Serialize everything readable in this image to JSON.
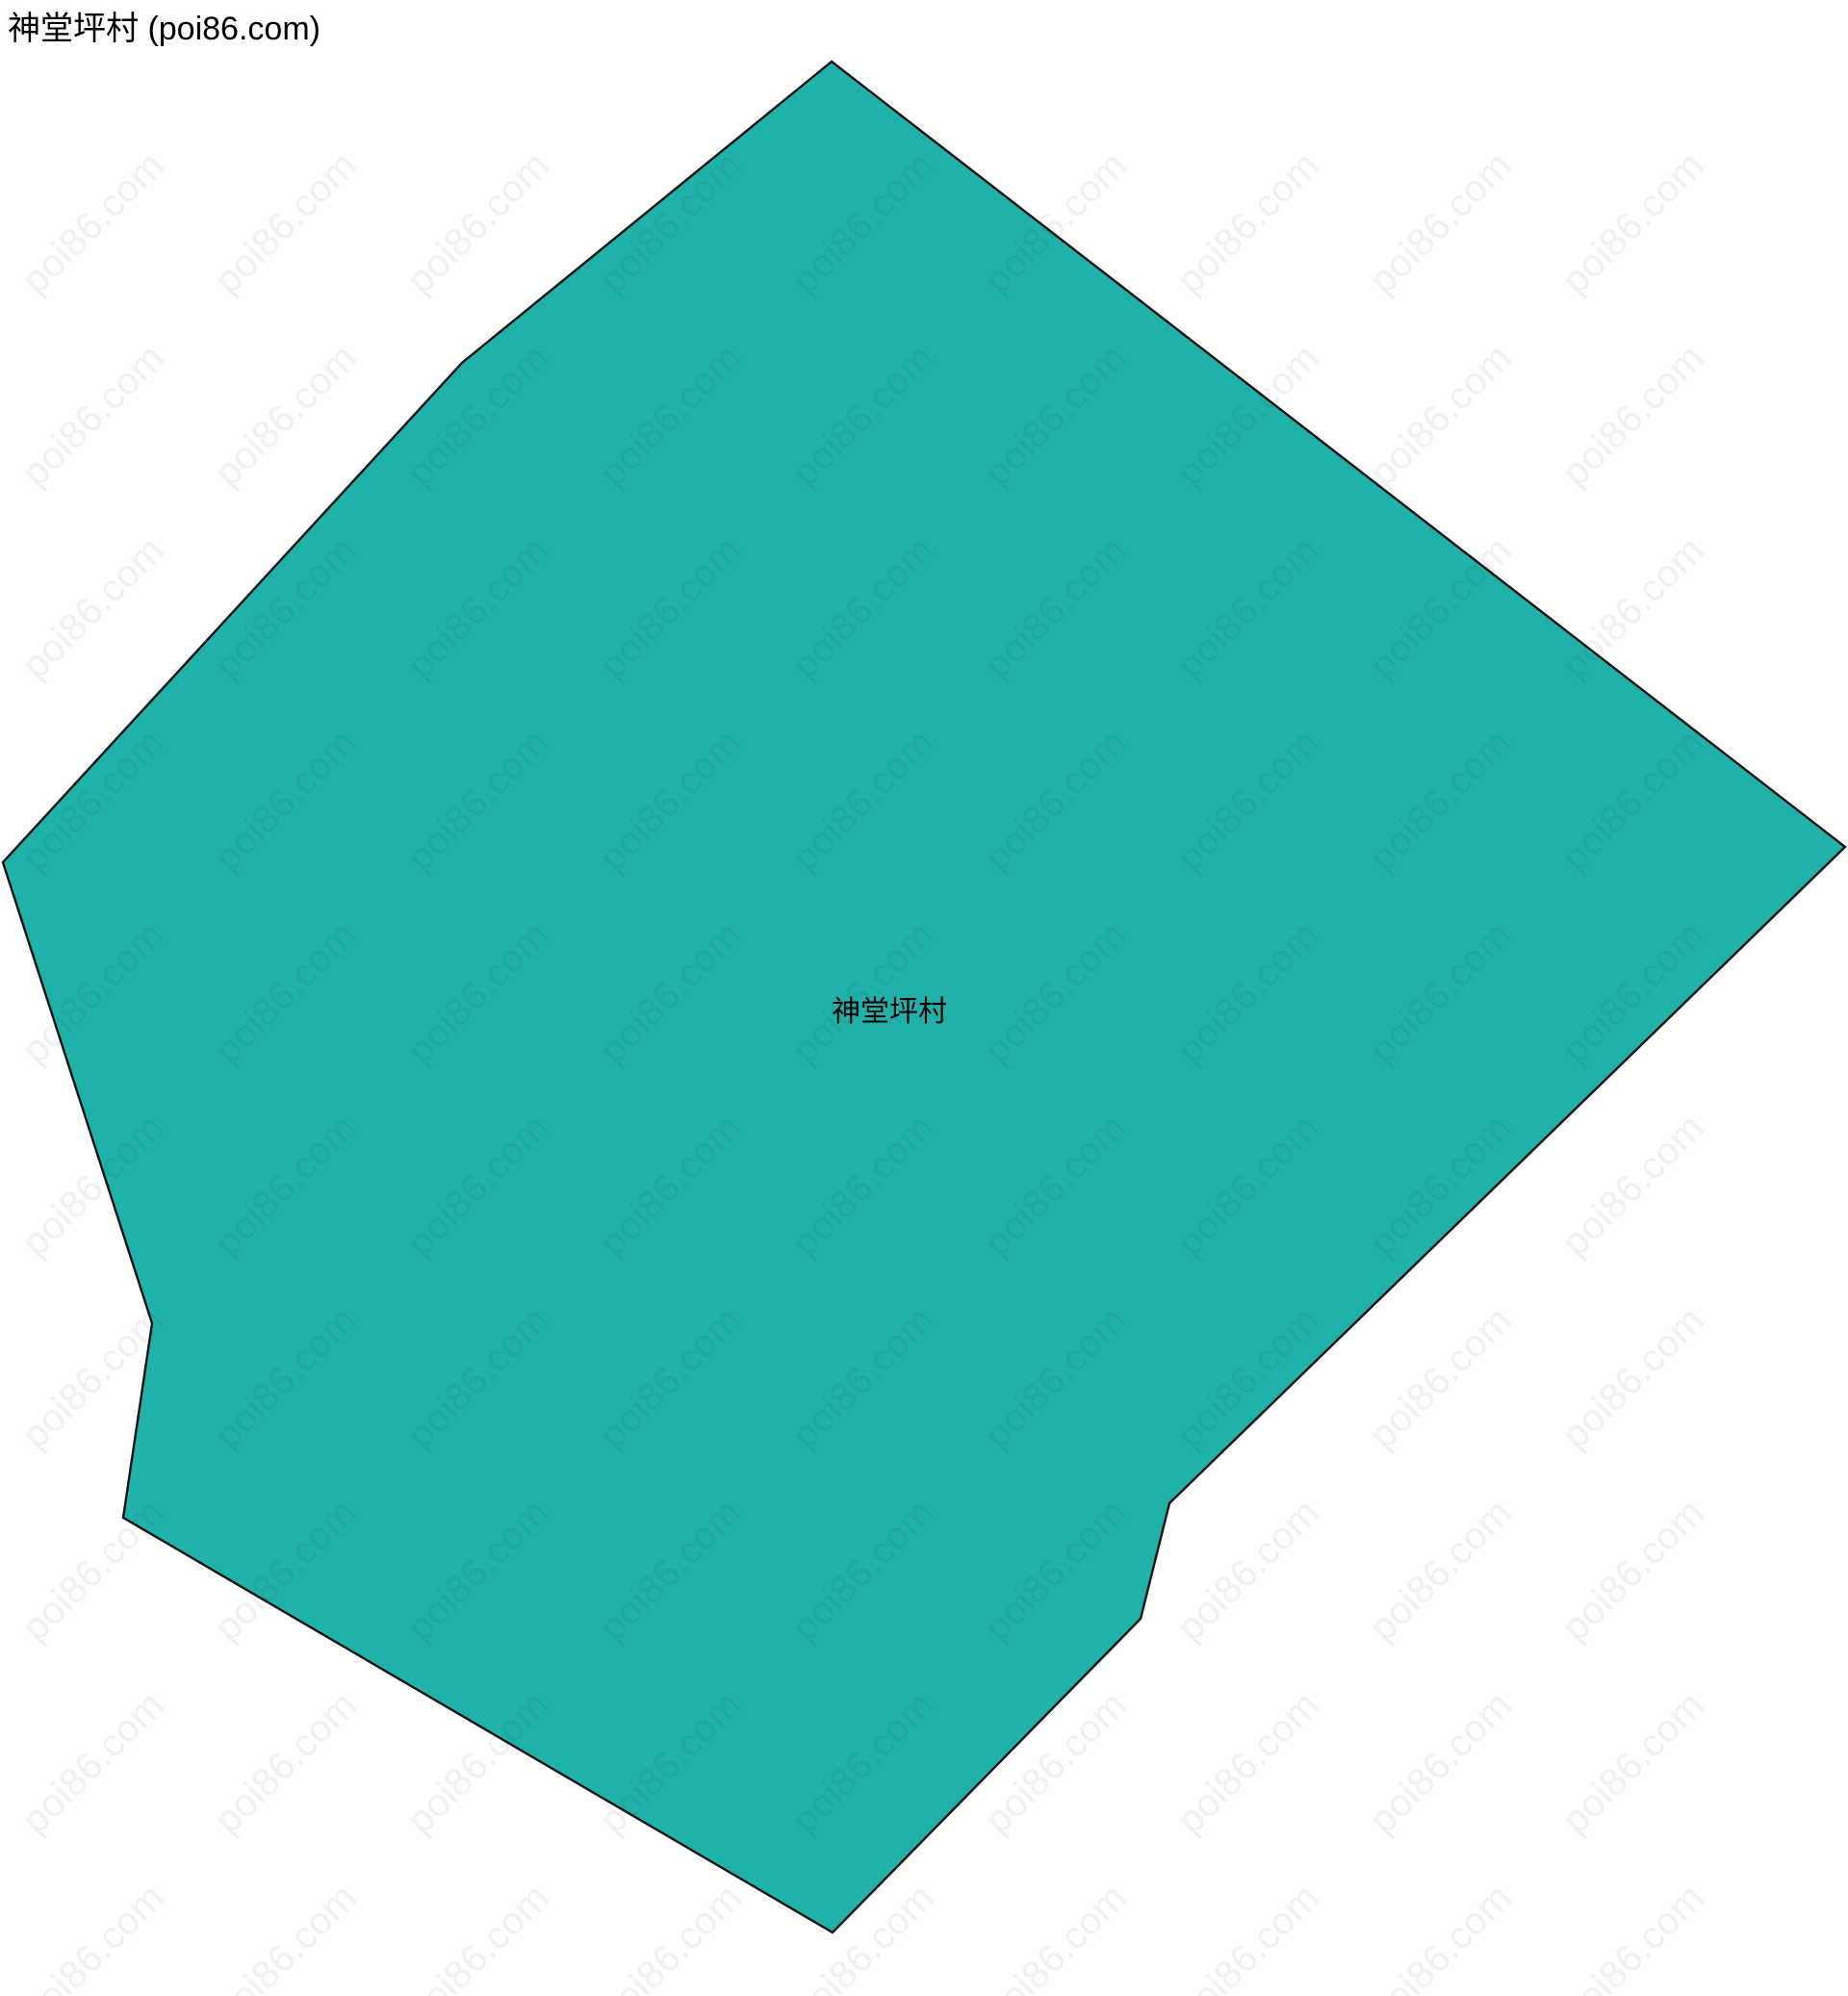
{
  "page_title": "神堂坪村 (poi86.com)",
  "map": {
    "region_label": "神堂坪村",
    "fill_color": "#20B2AA",
    "stroke_color": "#111111",
    "background_color": "#FFFFFF",
    "polygon_points": [
      [
        864,
        64
      ],
      [
        1917,
        880
      ],
      [
        1215,
        1562
      ],
      [
        1185,
        1682
      ],
      [
        865,
        2008
      ],
      [
        128,
        1577
      ],
      [
        158,
        1375
      ],
      [
        3,
        896
      ],
      [
        480,
        377
      ]
    ]
  },
  "watermark": {
    "text": "poi86.com"
  }
}
